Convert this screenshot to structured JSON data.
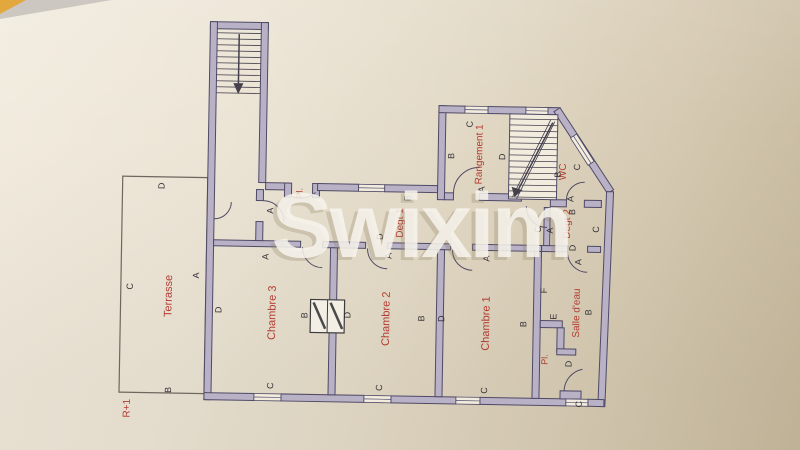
{
  "photo": {
    "watermark_text": "Swixim",
    "colors": {
      "paper": "#e9e2d3",
      "table": "#cd9334",
      "wall_fill": "#b9b1c6",
      "wall_line": "#4f4a66",
      "red_label": "#b23a30",
      "marker_text": "#332f35",
      "watermark": "#f8f5ee"
    }
  },
  "plan": {
    "floor_label": "R+1",
    "room_labels": [
      {
        "text": "Terrasse",
        "x": 172,
        "y": 300,
        "s": 11
      },
      {
        "text": "R+1",
        "x": 132,
        "y": 413,
        "s": 10
      },
      {
        "text": "Chambre 3",
        "x": 276,
        "y": 315,
        "s": 11
      },
      {
        "text": "Chambre 2",
        "x": 390,
        "y": 319,
        "s": 11
      },
      {
        "text": "Chambre 1",
        "x": 490,
        "y": 322,
        "s": 11
      },
      {
        "text": "Degt 1",
        "x": 402,
        "y": 223,
        "s": 10
      },
      {
        "text": "Degt 2",
        "x": 569,
        "y": 221,
        "s": 10
      },
      {
        "text": "WC",
        "x": 564,
        "y": 169,
        "s": 10
      },
      {
        "text": "Rangement 1",
        "x": 480,
        "y": 153,
        "s": 10
      },
      {
        "text": "Salle d'eau",
        "x": 580,
        "y": 310,
        "s": 10
      },
      {
        "text": "Pl.",
        "x": 549,
        "y": 357,
        "s": 9
      },
      {
        "text": "Pl.",
        "x": 301,
        "y": 195,
        "s": 9
      }
    ],
    "wall_markers": [
      {
        "text": "D",
        "x": 163,
        "y": 190
      },
      {
        "text": "C",
        "x": 133,
        "y": 291
      },
      {
        "text": "B",
        "x": 173,
        "y": 394
      },
      {
        "text": "A",
        "x": 199,
        "y": 279
      },
      {
        "text": "A",
        "x": 272,
        "y": 213
      },
      {
        "text": "B",
        "x": 409,
        "y": 198
      },
      {
        "text": "A",
        "x": 268,
        "y": 259
      },
      {
        "text": "D",
        "x": 222,
        "y": 313
      },
      {
        "text": "C",
        "x": 275,
        "y": 388
      },
      {
        "text": "B",
        "x": 308,
        "y": 317
      },
      {
        "text": "D",
        "x": 351,
        "y": 316
      },
      {
        "text": "D",
        "x": 382,
        "y": 237
      },
      {
        "text": "A",
        "x": 391,
        "y": 256
      },
      {
        "text": "C",
        "x": 384,
        "y": 388
      },
      {
        "text": "B",
        "x": 425,
        "y": 318
      },
      {
        "text": "D",
        "x": 445,
        "y": 318
      },
      {
        "text": "A",
        "x": 489,
        "y": 257
      },
      {
        "text": "C",
        "x": 489,
        "y": 389
      },
      {
        "text": "B",
        "x": 527,
        "y": 322
      },
      {
        "text": "C",
        "x": 470,
        "y": 123
      },
      {
        "text": "B",
        "x": 452,
        "y": 155
      },
      {
        "text": "A",
        "x": 483,
        "y": 188
      },
      {
        "text": "D",
        "x": 503,
        "y": 155
      },
      {
        "text": "B",
        "x": 559,
        "y": 172
      },
      {
        "text": "C",
        "x": 578,
        "y": 164
      },
      {
        "text": "A",
        "x": 572,
        "y": 196
      },
      {
        "text": "B",
        "x": 574,
        "y": 209
      },
      {
        "text": "C",
        "x": 540,
        "y": 227
      },
      {
        "text": "A",
        "x": 552,
        "y": 228
      },
      {
        "text": "C",
        "x": 598,
        "y": 226
      },
      {
        "text": "D",
        "x": 575,
        "y": 245
      },
      {
        "text": "A",
        "x": 581,
        "y": 259
      },
      {
        "text": "F",
        "x": 547,
        "y": 288
      },
      {
        "text": "E",
        "x": 557,
        "y": 314
      },
      {
        "text": "D",
        "x": 573,
        "y": 361
      },
      {
        "text": "B",
        "x": 592,
        "y": 309
      },
      {
        "text": "C",
        "x": 584,
        "y": 401
      }
    ]
  }
}
